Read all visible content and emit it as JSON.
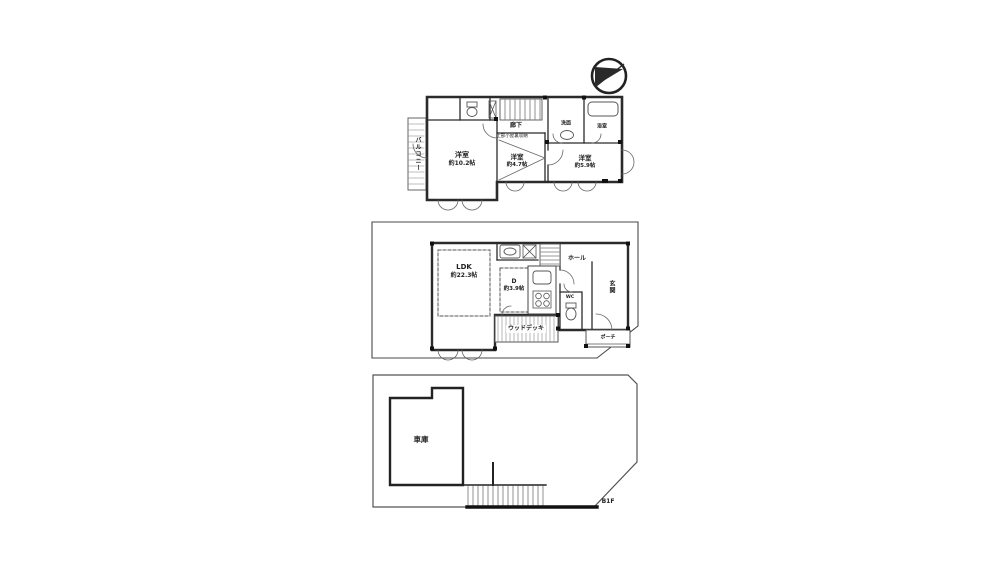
{
  "palette": {
    "ink": "#2b2b2b",
    "paper": "#ffffff"
  },
  "icons": {
    "compass": "compass-north",
    "toilet": "toilet-plan-icon",
    "bathtub": "bathtub-plan-icon",
    "sink": "sink-plan-icon",
    "stove": "stove-plan-icon",
    "stairs": "stairs-plan-icon"
  },
  "floors": {
    "f2": {
      "balcony_label": "バルコニー",
      "rooms": [
        {
          "name": "洋室",
          "size": "約10.2帖"
        },
        {
          "name": "洋室",
          "size": "約4.7帖"
        },
        {
          "name": "洋室",
          "size": "約5.9帖"
        }
      ],
      "corridor_label": "廊下",
      "corridor_note": "上部小屋裏収納",
      "washroom_label": "洗面",
      "bathroom_label": "浴室"
    },
    "f1": {
      "ldk": {
        "name": "LDK",
        "size": "約22.3帖"
      },
      "den": {
        "name": "D",
        "size": "約3.9帖"
      },
      "hall_label": "ホール",
      "entrance_label": "玄関",
      "wc_label": "WC",
      "porch_label": "ポーチ",
      "deck_label": "ウッドデッキ"
    },
    "b1": {
      "garage_label": "車庫",
      "floor_label": "B1F"
    }
  }
}
